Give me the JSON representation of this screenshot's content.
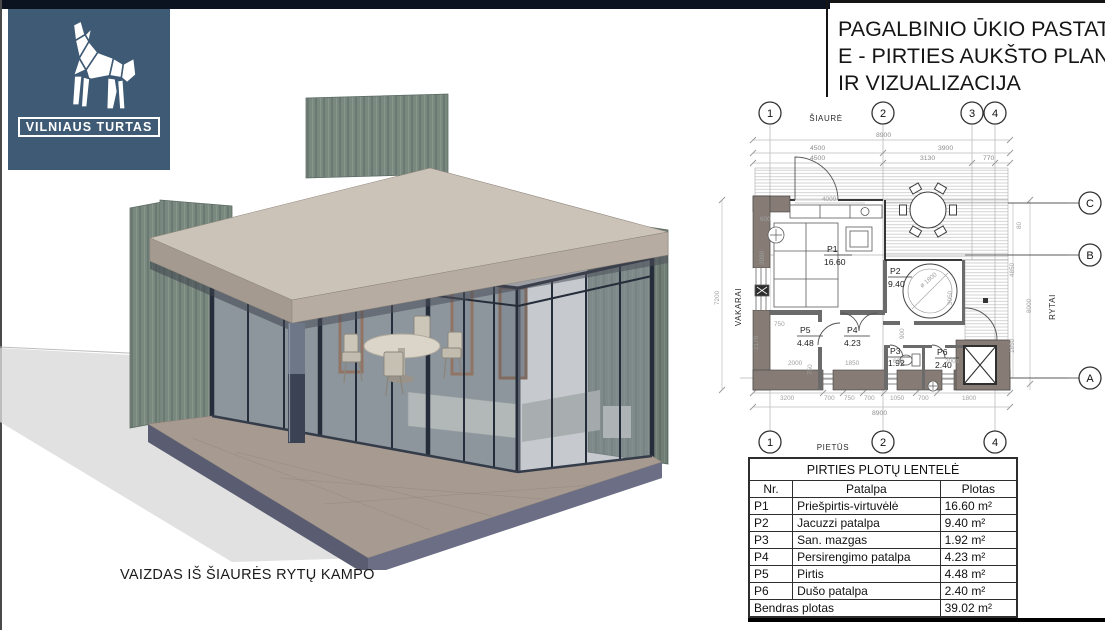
{
  "page": {
    "background": "#ffffff",
    "top_bar_color": "#0c1320",
    "frame_color": "#141414"
  },
  "logo": {
    "brand": "VILNIAUS TURTAS",
    "bg_color": "#3e5a74",
    "icon": "origami-wolf"
  },
  "title": {
    "lines": [
      "PAGALBINIO ŪKIO PASTATO",
      "E - PIRTIES AUKŠTO PLANAS",
      "IR VIZUALIZACIJA"
    ]
  },
  "visualization": {
    "caption": "VAIZDAS IŠ ŠIAURĖS RYTŲ KAMPO",
    "colors": {
      "siding": "#7a897f",
      "roof_top": "#cbc2b8",
      "roof_fascia": "#b6aca2",
      "glass": "#98a1a8",
      "frame": "#262d3a",
      "door": "#8a4f2c",
      "deck": "#a79a90",
      "deck_fascia": "#5a5d72",
      "column": "#3a4253"
    }
  },
  "floor_plan": {
    "compass": {
      "north": "ŠIAURĖ",
      "south": "PIETŪS",
      "west": "VAKARAI",
      "east": "RYTAI"
    },
    "grid_columns": [
      "1",
      "2",
      "3",
      "4"
    ],
    "grid_rows": [
      "A",
      "B",
      "C"
    ],
    "rooms": [
      {
        "id": "P1",
        "area": "16.60"
      },
      {
        "id": "P2",
        "area": "9.40"
      },
      {
        "id": "P3",
        "area": "1.92"
      },
      {
        "id": "P4",
        "area": "4.23"
      },
      {
        "id": "P5",
        "area": "4.48"
      },
      {
        "id": "P6",
        "area": "2.40"
      }
    ],
    "dims": {
      "d8900": "8900",
      "d4500": "4500",
      "d3900": "3900",
      "d3130": "3130",
      "d770": "770",
      "d4000": "4000",
      "d600": "600",
      "d3980": "3980",
      "d750": "750",
      "d2170": "2170",
      "d2000": "2000",
      "d1850": "1850",
      "d900": "900",
      "d3200": "3200",
      "d700": "700",
      "d1050": "1050",
      "d1800": "1800",
      "d7200": "7200",
      "d8000": "8000",
      "d4850": "4850",
      "d80": "80",
      "dia": "ø 1800",
      "d3050": "3050"
    }
  },
  "area_table": {
    "title": "PIRTIES PLOTŲ LENTELĖ",
    "headers": [
      "Nr.",
      "Patalpa",
      "Plotas"
    ],
    "rows": [
      [
        "P1",
        "Priešpirtis-virtuvėlė",
        "16.60 m²"
      ],
      [
        "P2",
        "Jacuzzi patalpa",
        "9.40 m²"
      ],
      [
        "P3",
        "San. mazgas",
        "1.92 m²"
      ],
      [
        "P4",
        "Persirengimo patalpa",
        "4.23 m²"
      ],
      [
        "P5",
        "Pirtis",
        "4.48 m²"
      ],
      [
        "P6",
        "Dušo patalpa",
        "2.40 m²"
      ]
    ],
    "footer": {
      "label": "Bendras plotas",
      "value": "39.02 m²"
    }
  }
}
